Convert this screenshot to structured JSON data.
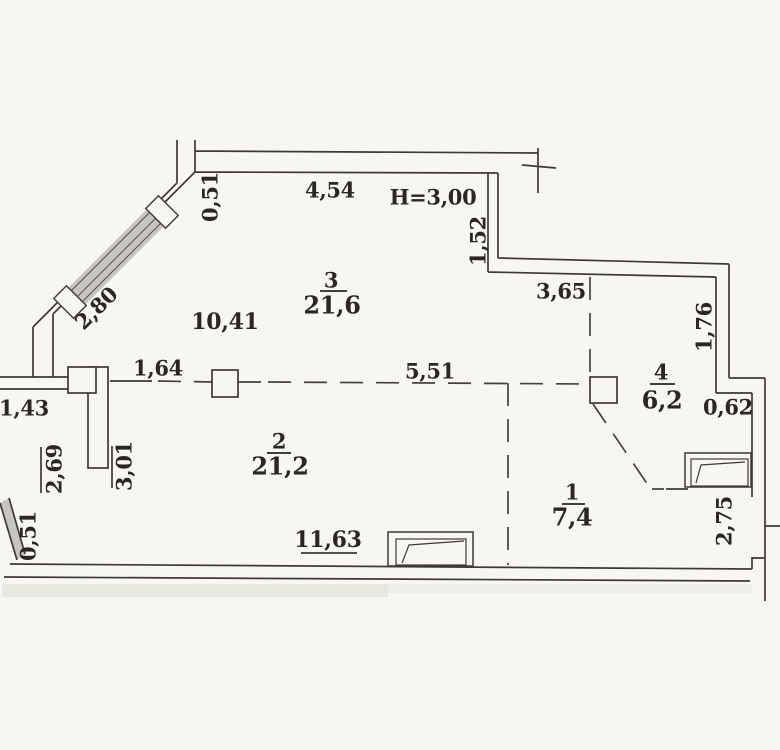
{
  "document": {
    "type": "apartment-floor-plan-scan",
    "height_note": "H=3,00"
  },
  "rooms": [
    {
      "number": "1",
      "area": "7,4"
    },
    {
      "number": "2",
      "area": "21,2"
    },
    {
      "number": "3",
      "area": "21,6"
    },
    {
      "number": "4",
      "area": "6,2"
    }
  ],
  "dimensions": {
    "top_offset": "0,51",
    "top_wall": "4,54",
    "right_step_upper": "1,52",
    "diagonal_window": "2,80",
    "room3_width": "10,41",
    "mid_wall": "3,65",
    "right_wall_upper": "1,76",
    "column_spacing": "1,64",
    "open_span": "5,51",
    "left_stub": "1,43",
    "step_width": "0,62",
    "left_lower": "2,69",
    "partition": "3,01",
    "bottom_wall": "11,63",
    "bottom_offset": "0,51",
    "right_wall_lower": "2,75"
  },
  "colors": {
    "paper": "#f7f6f1",
    "ink": "#3e3a33",
    "text": "#2a2722",
    "window_hatch": "#c7c5c0"
  }
}
